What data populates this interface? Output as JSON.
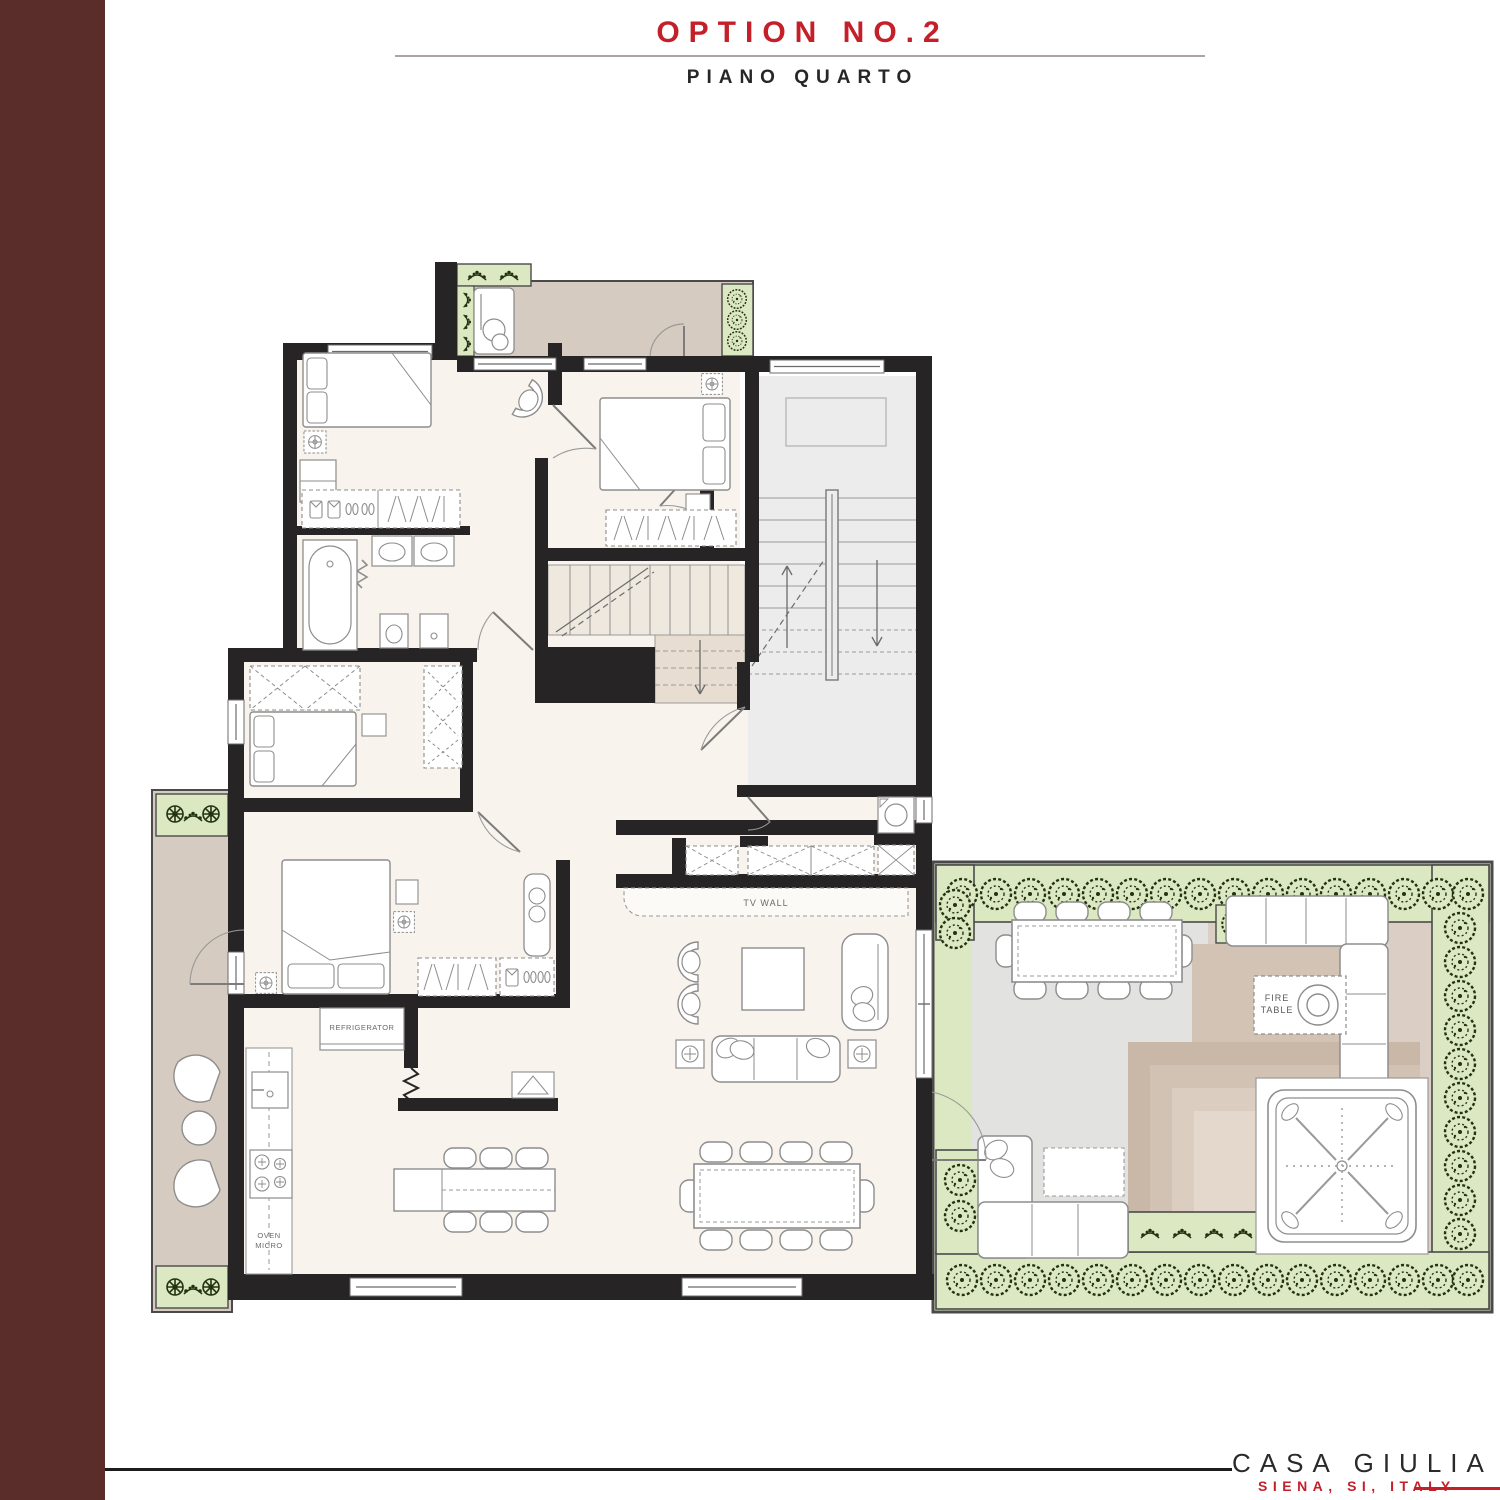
{
  "header": {
    "title": "OPTION NO.2",
    "subtitle": "PIANO QUARTO"
  },
  "sidebar": {
    "label": "FLOOR PLANS"
  },
  "footer": {
    "project": "CASA GIULIA",
    "location": "SIENA, SI, ITALY"
  },
  "plan": {
    "labels": {
      "tv_wall": "TV WALL",
      "fire_line1": "FIRE",
      "fire_line2": "TABLE",
      "refrigerator": "REFRIGERATOR",
      "oven_line1": "OVEN",
      "oven_line2": "MICRO"
    },
    "colors": {
      "accent_red": "#C4202A",
      "sidebar_maroon": "#5A2D2B",
      "wall": "#262424",
      "floor_cream": "#F8F3ED",
      "balcony_taupe": "#D6CBC0",
      "stairwell_gray": "#ECECEC",
      "terrace_gray": "#E2E2E1",
      "lounge_taupe": "#DBCFC5",
      "planter_green": "#DCE8C2",
      "plant_dark": "#233312"
    }
  }
}
